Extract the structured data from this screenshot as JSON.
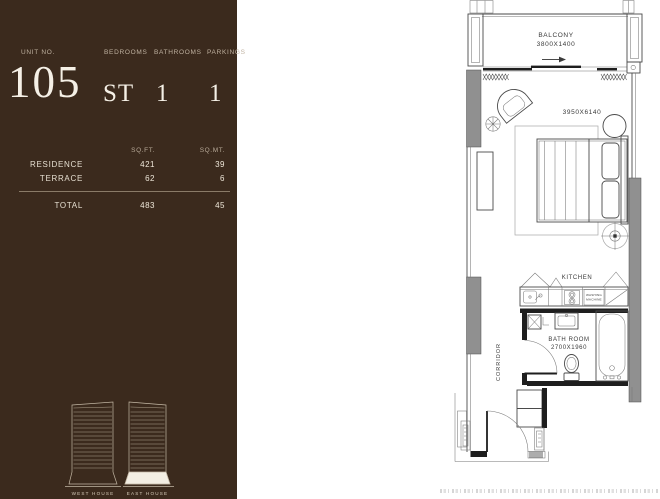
{
  "sidebar": {
    "unit_label": "UNIT NO.",
    "unit_number": "105",
    "columns": [
      {
        "label": "BEDROOMS",
        "value": "ST"
      },
      {
        "label": "BATHROOMS",
        "value": "1"
      },
      {
        "label": "PARKINGS",
        "value": "1"
      }
    ],
    "area_table": {
      "headers": {
        "sqft": "SQ.FT.",
        "sqmt": "SQ.MT."
      },
      "rows": [
        {
          "label": "RESIDENCE",
          "sqft": "421",
          "sqmt": "39"
        },
        {
          "label": "TERRACE",
          "sqft": "62",
          "sqmt": "6"
        }
      ],
      "total": {
        "label": "TOTAL",
        "sqft": "483",
        "sqmt": "45"
      }
    },
    "towers": [
      {
        "label": "WEST HOUSE",
        "highlighted": false
      },
      {
        "label": "EAST HOUSE",
        "highlighted": true
      }
    ]
  },
  "floorplan": {
    "balcony_label": "BALCONY",
    "balcony_dim": "3800X1400",
    "room_dim": "3950X6140",
    "kitchen_label": "KITCHEN",
    "washing_machine": [
      "WASHING",
      "MACHINE"
    ],
    "bathroom_label": "BATH ROOM",
    "bathroom_dim": "2700X1960",
    "corridor_label": "CORRIDOR"
  },
  "colors": {
    "sidebar_bg": "#3B2A1D",
    "sidebar_text": "#F5F0E6",
    "sidebar_muted": "#BFB1A0",
    "plan_line": "#4A4A4A",
    "wall_column_fill": "#909090",
    "wall_black": "#1E1E1E"
  }
}
